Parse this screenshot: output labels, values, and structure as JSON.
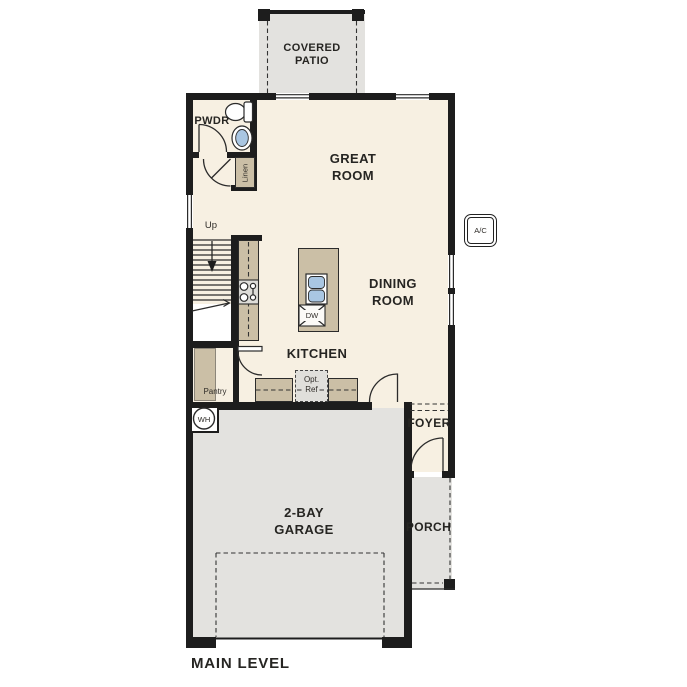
{
  "plan": {
    "level_label": "MAIN LEVEL"
  },
  "rooms": {
    "covered_patio": "COVERED\nPATIO",
    "great_room": "GREAT\nROOM",
    "dining_room": "DINING\nROOM",
    "kitchen": "KITCHEN",
    "powder_room": "PWDR",
    "foyer": "FOYER",
    "porch": "PORCH",
    "garage": "2-BAY\nGARAGE"
  },
  "closets": {
    "linen": "Linen",
    "pantry": "Pantry"
  },
  "fixtures": {
    "dishwasher": "DW",
    "optional_refrigerator": "Opt.\nRef",
    "water_heater": "WH",
    "air_conditioner": "A/C"
  },
  "stairs": {
    "direction": "Up"
  },
  "colors": {
    "wall": "#1d1d1d",
    "interior_floor": "#f7f0e2",
    "exterior_concrete": "#e3e2df",
    "casework_tan": "#cbbfa6",
    "plumbing_blue": "#a9c6e2",
    "label_text": "#262522"
  }
}
